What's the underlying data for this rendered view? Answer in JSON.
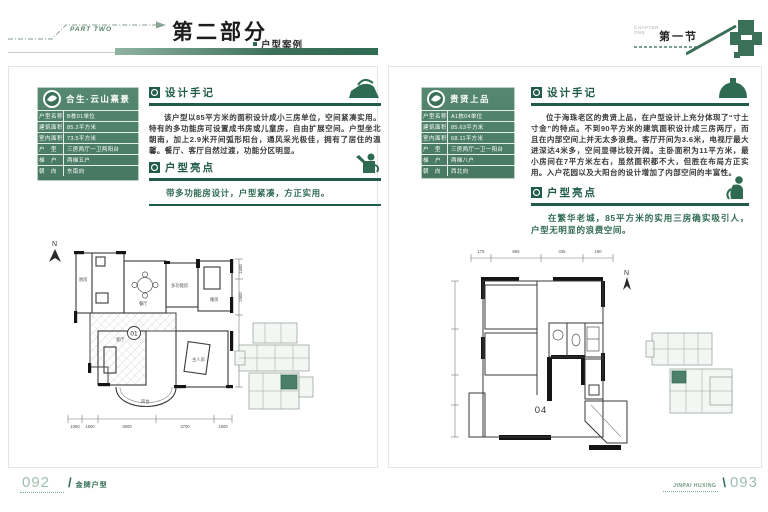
{
  "header": {
    "part_label": "PART TWO",
    "part_title": "第二部分",
    "part_subtitle": "户型案例",
    "section_eyebrow_line1": "CHAPTER",
    "section_eyebrow_line2": "ONE",
    "section_title": "第一节"
  },
  "colors": {
    "accent_green": "#2f6b52",
    "box_green": "#4c7f69",
    "light_green": "#9dbfae"
  },
  "icons": [
    "part-arrow-icon",
    "house-icon",
    "badge-icon",
    "logo-icon",
    "iron-icon",
    "pot-icon",
    "watering-can-icon",
    "figure-icon",
    "compass-icon"
  ],
  "left_page": {
    "project_name": "合生·云山熹景",
    "fields": [
      {
        "label": "户型名称",
        "value": "B栋01单位"
      },
      {
        "label": "建筑面积",
        "value": "85.2平方米"
      },
      {
        "label": "室内面积",
        "value": "73.5平方米"
      },
      {
        "label": "户　型",
        "value": "三房两厅一卫两阳台"
      },
      {
        "label": "梯　户",
        "value": "两梯五户"
      },
      {
        "label": "朝　向",
        "value": "东南向"
      }
    ],
    "design_notes_title": "设计手记",
    "design_notes_text": "该户型以85平方米的面积设计成小三房单位，空间紧凑实用。特有的多功能房可设置成书房或儿童房，自由扩展空间。户型坐北朝南，加上2.9米开间弧形阳台，通风采光极佳，拥有了居住的温馨。餐厅、客厅自然过渡，功能分区明显。",
    "highlights_title": "户型亮点",
    "highlights_text": "带多功能房设计，户型紧凑，方正实用。",
    "plan": {
      "compass": "N",
      "unit_label": "01",
      "rooms": [
        "厨房",
        "餐厅",
        "多功能房",
        "睡房",
        "客厅",
        "主人房",
        "阳台"
      ],
      "dims_bottom": [
        "1050",
        "1500",
        "3600",
        "3700",
        "1500"
      ],
      "dims_right": [
        "1500",
        "2600",
        "3800"
      ]
    }
  },
  "right_page": {
    "project_name": "贵贤上品",
    "fields": [
      {
        "label": "户型名称",
        "value": "A1栋04单位"
      },
      {
        "label": "建筑面积",
        "value": "85.63平方米"
      },
      {
        "label": "室内面积",
        "value": "68.11平方米"
      },
      {
        "label": "户　型",
        "value": "三房两厅一卫一阳台"
      },
      {
        "label": "梯　户",
        "value": "两梯八户"
      },
      {
        "label": "朝　向",
        "value": "西北向"
      }
    ],
    "design_notes_title": "设计手记",
    "design_notes_text": "位于海珠老区的贵贤上品，在户型设计上充分体现了“寸土寸金”的特点。不到90平方米的建筑面积设计成三房两厅，而且在内部空间上并无太多浪费。客厅开间为3.6米，电视厅最大进深达4米多，空间显得比较开阔。主卧面积为11平方米，最小房间在7平方米左右，虽然面积都不大，但胜在布局方正实用。入户花园以及大阳台的设计增加了内部空间的丰富性。",
    "highlights_title": "户型亮点",
    "highlights_text": "在繁华老城，85平方米的实用三房确实吸引人，户型无明显的浪费空间。",
    "plan": {
      "compass": "N",
      "unit_label": "04",
      "dims_top": [
        "175",
        "855",
        "335",
        "190"
      ]
    }
  },
  "footer": {
    "left_page_number": "092",
    "left_label": "金牌户型",
    "right_label": "JINPAI HUXING",
    "right_page_number": "093"
  }
}
